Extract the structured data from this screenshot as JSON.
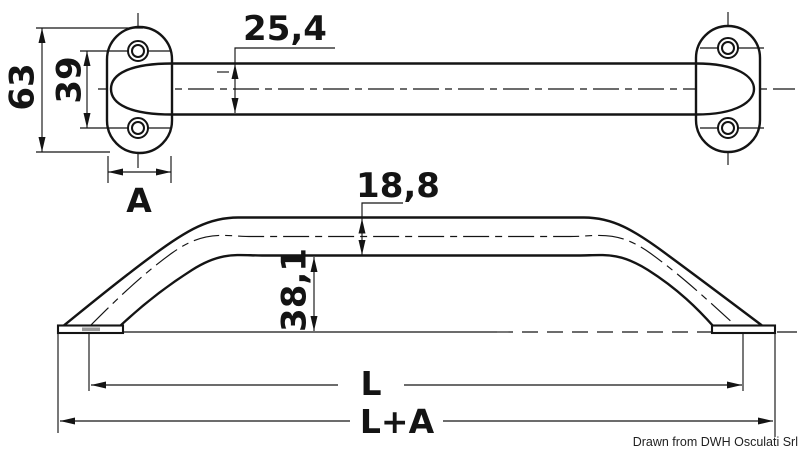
{
  "views": {
    "top": {
      "flange_height": "63",
      "hole_spacing": "39",
      "tube_width": "25,4",
      "flange_width": "A"
    },
    "side": {
      "tube_height": "18,8",
      "rail_height": "38,1",
      "length_centers": "L",
      "length_overall": "L+A"
    }
  },
  "footer": {
    "credit": "Drawn from DWH Osculati Srl"
  },
  "colors": {
    "line": "#141414",
    "background": "#ffffff",
    "section_shading": "#9a9a9a"
  }
}
